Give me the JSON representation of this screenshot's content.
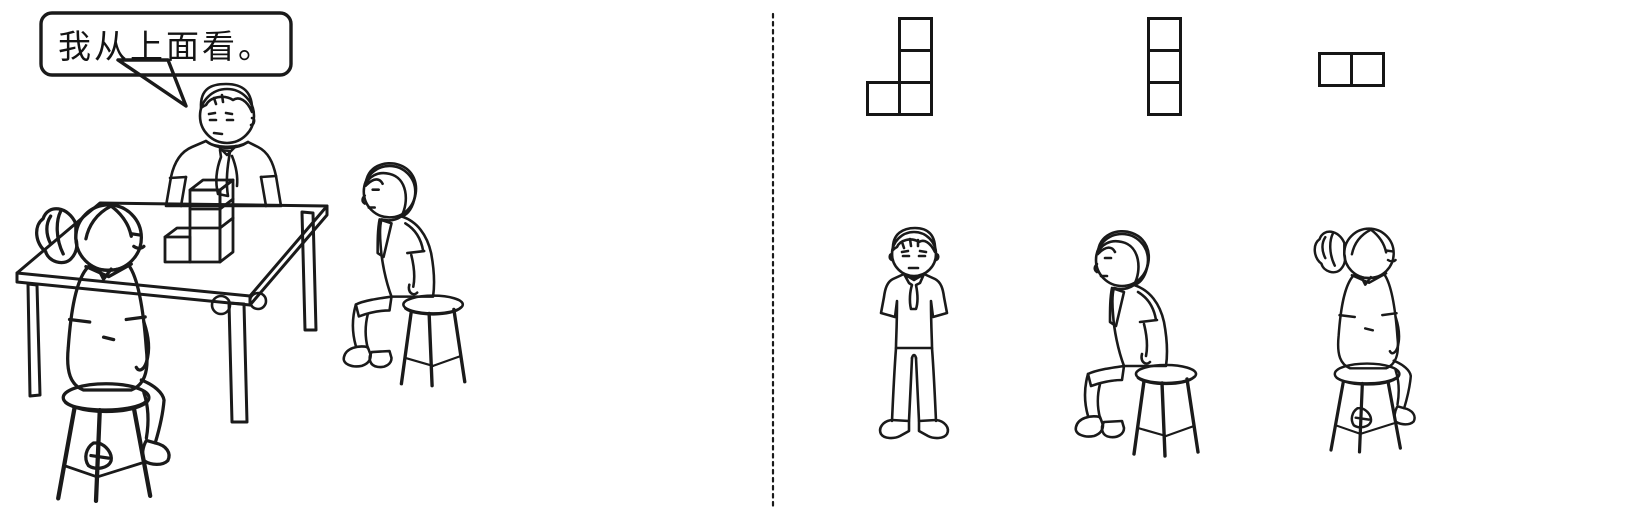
{
  "ink": "#1a1a1a",
  "background": "#ffffff",
  "left_scene": {
    "speech_bubble": {
      "text": "我从上面看。",
      "speaker": "standing-boy"
    },
    "figures": [
      "standing-boy-behind-table",
      "seated-girl-back-view",
      "seated-boy-side-view"
    ],
    "cube_block": {
      "total_cubes": 4,
      "arrangement": "column of 3 cubes with 1 cube attached at the left of the bottom cube, standing on the table"
    }
  },
  "divider": {
    "style": "dashed-vertical-line"
  },
  "right_panel": {
    "square_size": 35,
    "border_px": 3,
    "shapes": [
      {
        "id": "view-shape-1",
        "rows": 3,
        "cols": 2,
        "cells": [
          [
            0,
            1
          ],
          [
            1,
            1
          ],
          [
            2,
            0
          ],
          [
            2,
            1
          ]
        ]
      },
      {
        "id": "view-shape-2",
        "rows": 3,
        "cols": 1,
        "cells": [
          [
            0,
            0
          ],
          [
            1,
            0
          ],
          [
            2,
            0
          ]
        ]
      },
      {
        "id": "view-shape-3",
        "rows": 1,
        "cols": 2,
        "cells": [
          [
            0,
            0
          ],
          [
            0,
            1
          ]
        ]
      }
    ],
    "figures": [
      "standing-boy-front-view",
      "seated-boy-side-view",
      "seated-girl-back-view"
    ]
  }
}
